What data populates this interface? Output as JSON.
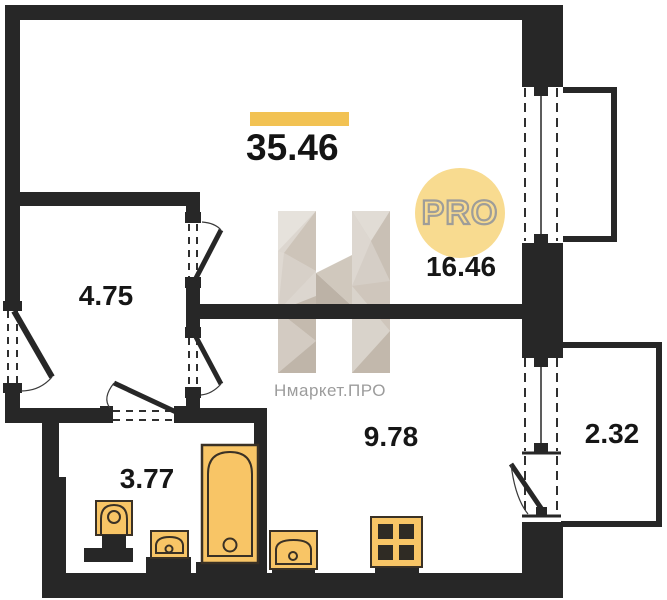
{
  "plan": {
    "total_area": "35.46",
    "badge": "PRO",
    "brand": "Нмаркет.ПРО",
    "rooms": [
      {
        "id": "living-room",
        "area": "16.46"
      },
      {
        "id": "hallway",
        "area": "4.75"
      },
      {
        "id": "kitchen",
        "area": "9.78"
      },
      {
        "id": "bathroom",
        "area": "3.77"
      },
      {
        "id": "balcony",
        "area": "2.32"
      }
    ],
    "fixtures": [
      "toilet",
      "sink",
      "bathtub",
      "kitchen-sink",
      "stove"
    ],
    "openings": [
      "entrance-door",
      "interior-door",
      "interior-door",
      "bathroom-door",
      "window",
      "window",
      "balcony-door"
    ],
    "colors": {
      "wall": "#272727",
      "fixture_fill": "#F8C566",
      "fixture_outline": "#3A3125",
      "accent_bar": "#F2C253",
      "badge_bg": "#F8DB90",
      "badge_text": "#9E9D99",
      "watermark_text": "#9C9C9C"
    }
  }
}
